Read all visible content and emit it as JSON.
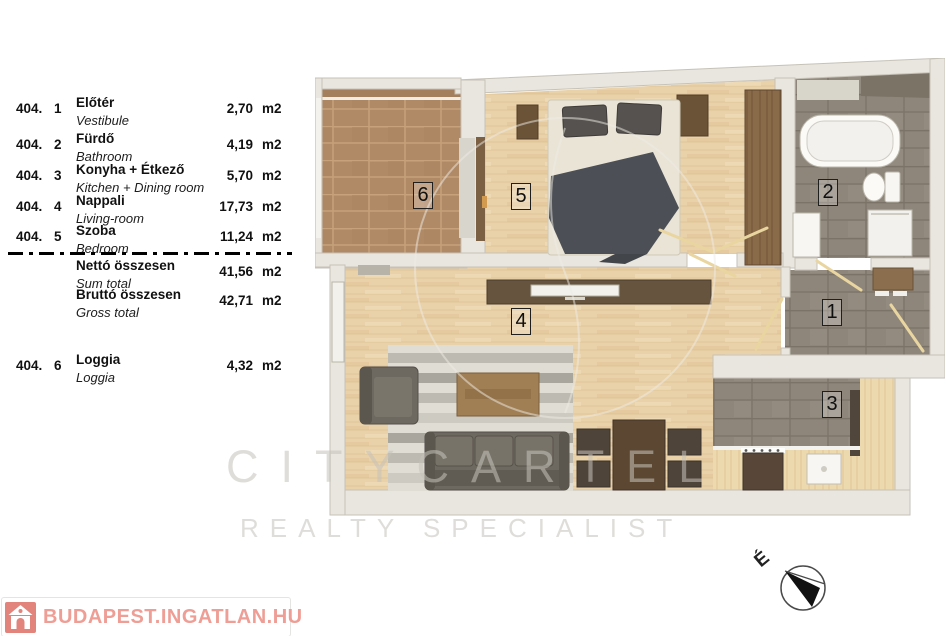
{
  "legend": {
    "rows": [
      {
        "code": "404.",
        "index": "1",
        "name_hu": "Előtér",
        "name_en": "Vestibule",
        "area": "2,70",
        "unit": "m2"
      },
      {
        "code": "404.",
        "index": "2",
        "name_hu": "Fürdő",
        "name_en": "Bathroom",
        "area": "4,19",
        "unit": "m2"
      },
      {
        "code": "404.",
        "index": "3",
        "name_hu": "Konyha + Étkező",
        "name_en": "Kitchen + Dining room",
        "area": "5,70",
        "unit": "m2"
      },
      {
        "code": "404.",
        "index": "4",
        "name_hu": "Nappali",
        "name_en": "Living-room",
        "area": "17,73",
        "unit": "m2"
      },
      {
        "code": "404.",
        "index": "5",
        "name_hu": "Szoba",
        "name_en": "Bedroom",
        "area": "11,24",
        "unit": "m2"
      }
    ],
    "totals": [
      {
        "name_hu": "Nettó összesen",
        "name_en": "Sum total",
        "area": "41,56",
        "unit": "m2"
      },
      {
        "name_hu": "Bruttó összesen",
        "name_en": "Gross total",
        "area": "42,71",
        "unit": "m2"
      }
    ],
    "extra_rows": [
      {
        "code": "404.",
        "index": "6",
        "name_hu": "Loggia",
        "name_en": "Loggia",
        "area": "4,32",
        "unit": "m2"
      }
    ]
  },
  "plan": {
    "rooms": [
      {
        "number": "1",
        "name": "vestibule"
      },
      {
        "number": "2",
        "name": "bathroom"
      },
      {
        "number": "3",
        "name": "kitchen-dining"
      },
      {
        "number": "4",
        "name": "living-room"
      },
      {
        "number": "5",
        "name": "bedroom"
      },
      {
        "number": "6",
        "name": "loggia"
      }
    ]
  },
  "watermark": {
    "line1": "CITYCARTEL",
    "line2": "REALTY SPECIALIST"
  },
  "compass": {
    "north_label": "É"
  },
  "footer_logo": {
    "text": "BUDAPEST.INGATLAN.HU"
  },
  "colors": {
    "logo_red": "#ee9e95",
    "logo_icon_bg": "#e2837c",
    "wall": "#e9e6df",
    "wood_floor": "#e9d2a9",
    "tile_terracotta": "#b08a66",
    "tile_grey": "#8e867b"
  }
}
